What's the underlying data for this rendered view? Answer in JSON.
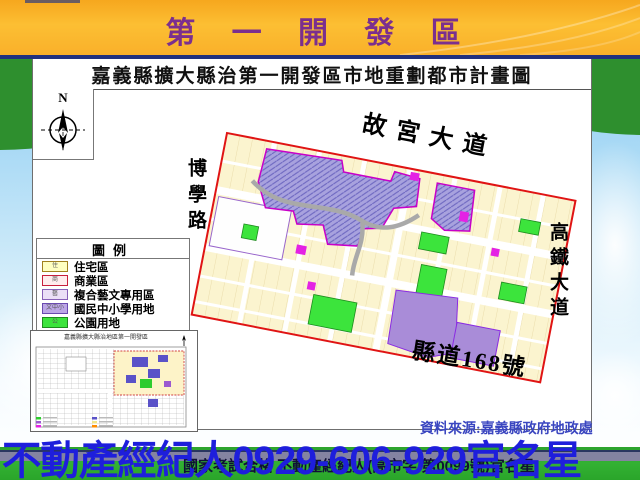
{
  "title_bar": {
    "title": "第 一 開 發 區"
  },
  "map_panel": {
    "title": "嘉義縣擴大縣治第一開發區市地重劃都市計畫圖",
    "compass_n": "N",
    "streets": {
      "top": "故宮大道",
      "left": "博學路",
      "right": "高鐵大道",
      "bottom": "縣道168號"
    },
    "legend": {
      "title": "圖例",
      "items": [
        {
          "key": "住",
          "label": "住宅區",
          "style": "background:#ffffc2;border-color:#a08020"
        },
        {
          "key": "商",
          "label": "商業區",
          "style": "background:#ffecee;border-color:#c81e3c"
        },
        {
          "key": "藝",
          "label": "複合藝文專用區",
          "style": "background:#ebdff7;border-color:#8860b8"
        },
        {
          "key": "文中小",
          "label": "國民中小學用地",
          "style": "background:#bca6e6;border-color:#6a4ab0"
        },
        {
          "key": "公",
          "label": "公園用地",
          "style": "background:#3ce43c;border-color:#1e8c1e"
        }
      ]
    },
    "inset": {
      "title": "嘉義縣擴大縣治地區第一開發區"
    },
    "source": "資料來源:嘉義縣政府地政處"
  },
  "footer": {
    "agent_line": "不動產經紀人0929-606-929官名星",
    "license_line": "國家考試合格 不動產經紀人(高市字 第0099號)官名星"
  },
  "colors": {
    "accent_blue": "#1e1edc",
    "title_purple": "#7b2f8e",
    "boundary_red": "#e01414",
    "park_green": "#3ce43c",
    "school_purple": "#a8a2de",
    "grass_green": "#33b133"
  }
}
